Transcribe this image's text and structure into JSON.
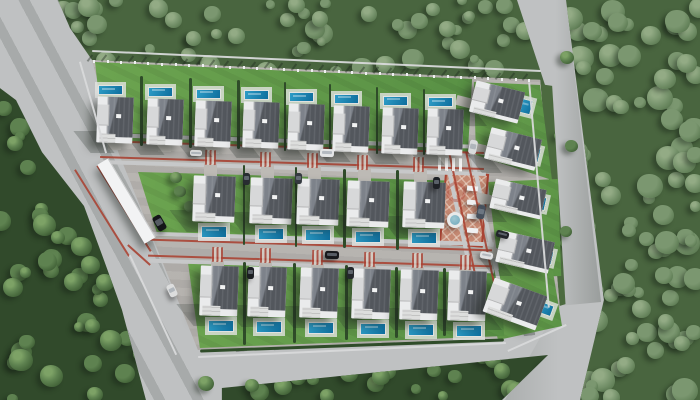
{
  "meta": {
    "title": "Aerial 3D render of a gated villa community in a forest",
    "view": "top-down drone view",
    "text_content": "none"
  },
  "palette": {
    "road": "#bfc1c2",
    "pavement": "#b6b3af",
    "sidewalk": "#c7c8c9",
    "red_edge": "#aa4434",
    "lawn": "#67a04d",
    "hedge": "#2f4c29",
    "forest_dark_tones": [
      "#7da266",
      "#5e8250",
      "#47683c",
      "#35512d"
    ],
    "forest_light_tones": [
      "#93ab85",
      "#7b9770",
      "#64825a",
      "#516e49"
    ],
    "roof_dark": "#53575d",
    "roof_light": "#7d828a",
    "wall_white": "#eaebec",
    "pool_blue": "#2d9cc6",
    "pool_deep": "#0f6f9e",
    "plaza": "#c58973",
    "canopy_white": "#f2f3f4"
  },
  "counts": {
    "houses_total": 24,
    "pools_total": 24,
    "cars_visible": 14,
    "rows": 3,
    "rotated_houses_right_side": 5
  },
  "forests": [
    {
      "name": "forest-left",
      "box": [
        0,
        85,
        150,
        315
      ],
      "clip": "0% 1%,10.7% 4.8%,28% 21.3%,56% 38.4%,69.3% 55.6%,81.3% 71.4%,97.3% 100%,0% 100%",
      "count": 58,
      "tone": "dark",
      "size": [
        10,
        24
      ],
      "seed": 11,
      "base": "#314a2b"
    },
    {
      "name": "forest-top",
      "box": [
        55,
        0,
        500,
        92
      ],
      "clip": "0.6% 0%,92.4% 0%,98.2% 95.7%,7.4% 65.2%,3% 30.4%",
      "count": 70,
      "tone": "light",
      "size": [
        9,
        22
      ],
      "seed": 22,
      "base": "#49653f"
    },
    {
      "name": "forest-right",
      "box": [
        560,
        0,
        140,
        400
      ],
      "clip": "4.3% 0%,100% 0%,100% 100%,14.3% 100%,31.4% 75%",
      "count": 100,
      "tone": "light",
      "size": [
        11,
        26
      ],
      "seed": 33,
      "base": "#49653f"
    },
    {
      "name": "forest-bottom",
      "box": [
        210,
        340,
        360,
        60
      ],
      "clip": "3.3% 80%,93.9% 25%,81.1% 100%,3.3% 100%",
      "count": 32,
      "tone": "dark",
      "size": [
        9,
        20
      ],
      "seed": 44,
      "base": "#314a2b"
    },
    {
      "name": "forest-verge",
      "box": [
        538,
        82,
        30,
        228
      ],
      "clip": "5.6% 0.9%,47.2% 1.7%,91.7% 97.4%,50% 99.1%",
      "count": 10,
      "tone": "dark",
      "size": [
        6,
        12
      ],
      "seed": 55,
      "base": "#4c6a3f"
    }
  ],
  "road_shades": [
    {
      "name": "main-road-shade",
      "box": [
        0,
        0,
        230,
        400
      ],
      "clip": "0% 0%,25.2% 0%,93.5% 100%,61.7% 100%,0% 30%",
      "bg": "repeating-linear-gradient(62deg,rgba(48,58,50,0.17) 0 10px,rgba(0,0,0,0) 10px 34px)"
    },
    {
      "name": "right-road-shade",
      "box": [
        515,
        0,
        90,
        310
      ],
      "clip": "2.2% 0%,56.7% 0%,95.6% 97.4%,47.8% 98.7%",
      "bg": "linear-gradient(to left,rgba(45,55,47,0.28),rgba(0,0,0,0) 55%)"
    },
    {
      "name": "exit-road-shade",
      "box": [
        480,
        300,
        130,
        100
      ],
      "clip": "60% 6%,93.1% 2%,73.1% 100%,19.2% 100%",
      "bg": "linear-gradient(to right,rgba(45,55,47,0.2),rgba(0,0,0,0) 60%)"
    }
  ],
  "estate": {
    "base_box": [
      88,
      55,
      480,
      300
    ],
    "base_clip": "0.8% 1.7%,94.2% 8.3%,98.3% 84.3%,86.9% 94.3%,22.9% 98.3%,6.3% 32.3%",
    "lawns": [
      {
        "name": "lawn-top-row",
        "box": [
          92,
          58,
          382,
          96
        ],
        "clip": "0.8% 4.2%,99.5% 21.9%,98.4% 97.9%,3.1% 87.5%"
      },
      {
        "name": "lawn-top-right",
        "box": [
          470,
          78,
          92,
          104
        ],
        "clip": "4.3% 3.8%,76.1% 6.7%,89.1% 98.1%,6.5% 74%"
      },
      {
        "name": "lawn-right",
        "box": [
          484,
          176,
          92,
          104
        ],
        "clip": "4.3% 5.8%,80.4% 2.9%,84% 96.2%,17.4% 98.1%"
      },
      {
        "name": "lawn-bottom-right",
        "box": [
          478,
          264,
          100,
          80
        ],
        "clip": "4% 10%,74% 2.5%,84% 77.5%,20% 95%"
      },
      {
        "name": "lawn-middle-row",
        "box": [
          134,
          168,
          336,
          80
        ],
        "clip": "1.2% 5%,98.2% 16.3%,97.6% 95%,7.1% 85%"
      },
      {
        "name": "lawn-bottom-row",
        "box": [
          184,
          258,
          324,
          92
        ],
        "clip": "1.2% 4.3%,97.5% 13%,98.8% 84.8%,4.9% 97.8%"
      }
    ],
    "rows": {
      "top": {
        "xs": [
          97,
          147,
          195,
          243,
          288,
          333,
          382,
          427
        ],
        "y0": 97,
        "slope": 0.037,
        "w": 36,
        "h": 46,
        "pool": "above"
      },
      "middle": {
        "xs": [
          193,
          250,
          297,
          347,
          403
        ],
        "y0": 176,
        "slope": 0.03,
        "w": 42,
        "h": 46,
        "pool": "below"
      },
      "bottom": {
        "xs": [
          200,
          248,
          300,
          352,
          400,
          448
        ],
        "y0": 266,
        "slope": 0.02,
        "w": 38,
        "h": 50,
        "pool": "below"
      }
    },
    "rotated_houses": [
      {
        "x": 472,
        "y": 86,
        "w": 50,
        "h": 32,
        "rot": 14
      },
      {
        "x": 487,
        "y": 133,
        "w": 52,
        "h": 32,
        "rot": 14
      },
      {
        "x": 492,
        "y": 184,
        "w": 52,
        "h": 30,
        "rot": 13
      },
      {
        "x": 498,
        "y": 236,
        "w": 54,
        "h": 32,
        "rot": 13
      },
      {
        "x": 487,
        "y": 286,
        "w": 56,
        "h": 36,
        "rot": 20
      }
    ],
    "rotated_pools": [
      {
        "x": 519,
        "y": 99,
        "w": 13,
        "h": 15,
        "rot": 14
      },
      {
        "x": 528,
        "y": 147,
        "w": 12,
        "h": 15,
        "rot": 14
      },
      {
        "x": 533,
        "y": 196,
        "w": 13,
        "h": 14,
        "rot": 13
      },
      {
        "x": 540,
        "y": 250,
        "w": 13,
        "h": 14,
        "rot": 13
      },
      {
        "x": 538,
        "y": 303,
        "w": 15,
        "h": 12,
        "rot": 20
      }
    ],
    "streets": {
      "red_lines": [
        {
          "x": 100,
          "y": 145.5,
          "w": 384,
          "h": 2,
          "rot": 1.8
        },
        {
          "x": 100,
          "y": 161.5,
          "w": 384,
          "h": 2,
          "rot": 1.8
        },
        {
          "x": 148,
          "y": 243.5,
          "w": 344,
          "h": 2,
          "rot": 1.8
        },
        {
          "x": 148,
          "y": 259.5,
          "w": 344,
          "h": 2,
          "rot": 1.8
        },
        {
          "x": 464,
          "y": 152,
          "w": 2,
          "h": 150,
          "rot": -12
        },
        {
          "x": 481,
          "y": 150,
          "w": 2,
          "h": 153,
          "rot": -12
        },
        {
          "x": 101,
          "y": 162,
          "w": 2,
          "h": 102,
          "rot": -32
        },
        {
          "x": 123,
          "y": 158,
          "w": 2,
          "h": 101,
          "rot": -32
        },
        {
          "x": 138,
          "y": 240,
          "w": 2,
          "h": 30,
          "rot": -48
        }
      ],
      "sidewalks": [
        {
          "x": 100,
          "y": 139,
          "w": 386,
          "h": 4,
          "rot": 1.8
        },
        {
          "x": 100,
          "y": 166,
          "w": 386,
          "h": 4,
          "rot": 1.8
        },
        {
          "x": 148,
          "y": 237,
          "w": 346,
          "h": 4,
          "rot": 1.8
        },
        {
          "x": 148,
          "y": 264,
          "w": 346,
          "h": 4,
          "rot": 1.8
        },
        {
          "x": 459,
          "y": 152,
          "w": 4,
          "h": 150,
          "rot": -12
        },
        {
          "x": 485,
          "y": 150,
          "w": 4,
          "h": 152,
          "rot": -12
        }
      ],
      "crossings_upper": [
        205,
        260,
        307,
        357,
        413
      ],
      "crossings_lower": [
        212,
        260,
        312,
        364,
        412,
        460
      ],
      "zebra": {
        "x": 438,
        "y": 158,
        "w": 26,
        "h": 13,
        "rot": 2
      }
    },
    "fences": [
      {
        "x": 92,
        "y": 60,
        "w": 449,
        "h": 1.6,
        "rot": 2.56
      },
      {
        "x": 538,
        "y": 82,
        "w": 1.6,
        "h": 226,
        "rot": -5
      },
      {
        "x": 198,
        "y": 349,
        "w": 308,
        "h": 1.6,
        "rot": -2.6
      },
      {
        "x": 505,
        "y": 337,
        "w": 64,
        "h": 1.6,
        "rot": -24
      },
      {
        "x": 92,
        "y": 60,
        "w": 1.6,
        "h": 95,
        "rot": -16
      },
      {
        "x": 152,
        "y": 250,
        "w": 1.6,
        "h": 110,
        "rot": -25
      }
    ],
    "fence_posts": {
      "x0": 93,
      "y0": 60.5,
      "dx": 13.6,
      "dy": 0.6,
      "count": 33
    },
    "bottom_hedge": {
      "x": 200,
      "y": 344,
      "w": 304,
      "h": 3,
      "rot": -2.1
    },
    "plaza": {
      "x": 442,
      "y": 172,
      "w": 44,
      "h": 74,
      "rot": 5,
      "motif": {
        "x": 446,
        "y": 182,
        "d": 20
      },
      "pergolas_x": 467,
      "pergolas_y": [
        186,
        200,
        214,
        228
      ],
      "fountain": {
        "x": 447,
        "y": 212,
        "d": 16
      }
    },
    "gate": {
      "x": 120,
      "y": 155,
      "w": 13,
      "h": 92,
      "rot": -31
    },
    "entry_trees": [
      [
        180,
        192
      ],
      [
        190,
        207
      ],
      [
        176,
        178
      ]
    ],
    "cars": [
      {
        "x": 155,
        "y": 215,
        "w": 9,
        "h": 16,
        "rot": -30,
        "c": "#141519"
      },
      {
        "x": 320,
        "y": 149,
        "w": 14,
        "h": 8,
        "rot": 2,
        "c": "#e4e5e6"
      },
      {
        "x": 325,
        "y": 251,
        "w": 14,
        "h": 8,
        "rot": 2,
        "c": "#17181b"
      },
      {
        "x": 469,
        "y": 140,
        "w": 8,
        "h": 14,
        "rot": 11,
        "c": "#d9dbdc"
      },
      {
        "x": 477,
        "y": 205,
        "w": 8,
        "h": 14,
        "rot": 11,
        "c": "#46505c"
      },
      {
        "x": 496,
        "y": 231,
        "w": 13,
        "h": 7,
        "rot": 14,
        "c": "#22252a"
      },
      {
        "x": 243,
        "y": 173,
        "w": 7,
        "h": 12,
        "rot": 2,
        "c": "#282c31"
      },
      {
        "x": 295,
        "y": 173,
        "w": 7,
        "h": 11,
        "rot": 2,
        "c": "#34393f"
      },
      {
        "x": 433,
        "y": 177,
        "w": 7,
        "h": 12,
        "rot": 2,
        "c": "#1e2126"
      },
      {
        "x": 247,
        "y": 267,
        "w": 7,
        "h": 12,
        "rot": 1,
        "c": "#1b1e22"
      },
      {
        "x": 347,
        "y": 267,
        "w": 7,
        "h": 12,
        "rot": 1,
        "c": "#24272c"
      },
      {
        "x": 480,
        "y": 252,
        "w": 13,
        "h": 7,
        "rot": 10,
        "c": "#dfe0e1"
      },
      {
        "x": 190,
        "y": 150,
        "w": 12,
        "h": 6,
        "rot": 2,
        "c": "#d8d9da"
      },
      {
        "x": 168,
        "y": 284,
        "w": 8,
        "h": 13,
        "rot": -25,
        "c": "#dcdddd"
      }
    ]
  },
  "loose_trees": [
    [
      28,
      168,
      16
    ],
    [
      58,
      238,
      14
    ],
    [
      92,
      326,
      15
    ],
    [
      567,
      58,
      14
    ],
    [
      571,
      146,
      13
    ],
    [
      566,
      232,
      12
    ],
    [
      206,
      384,
      16
    ],
    [
      252,
      386,
      14
    ]
  ],
  "bottom_spikes": {
    "x0": 230,
    "step": 36,
    "count": 9,
    "y_base": 352,
    "drop": 0.055
  }
}
